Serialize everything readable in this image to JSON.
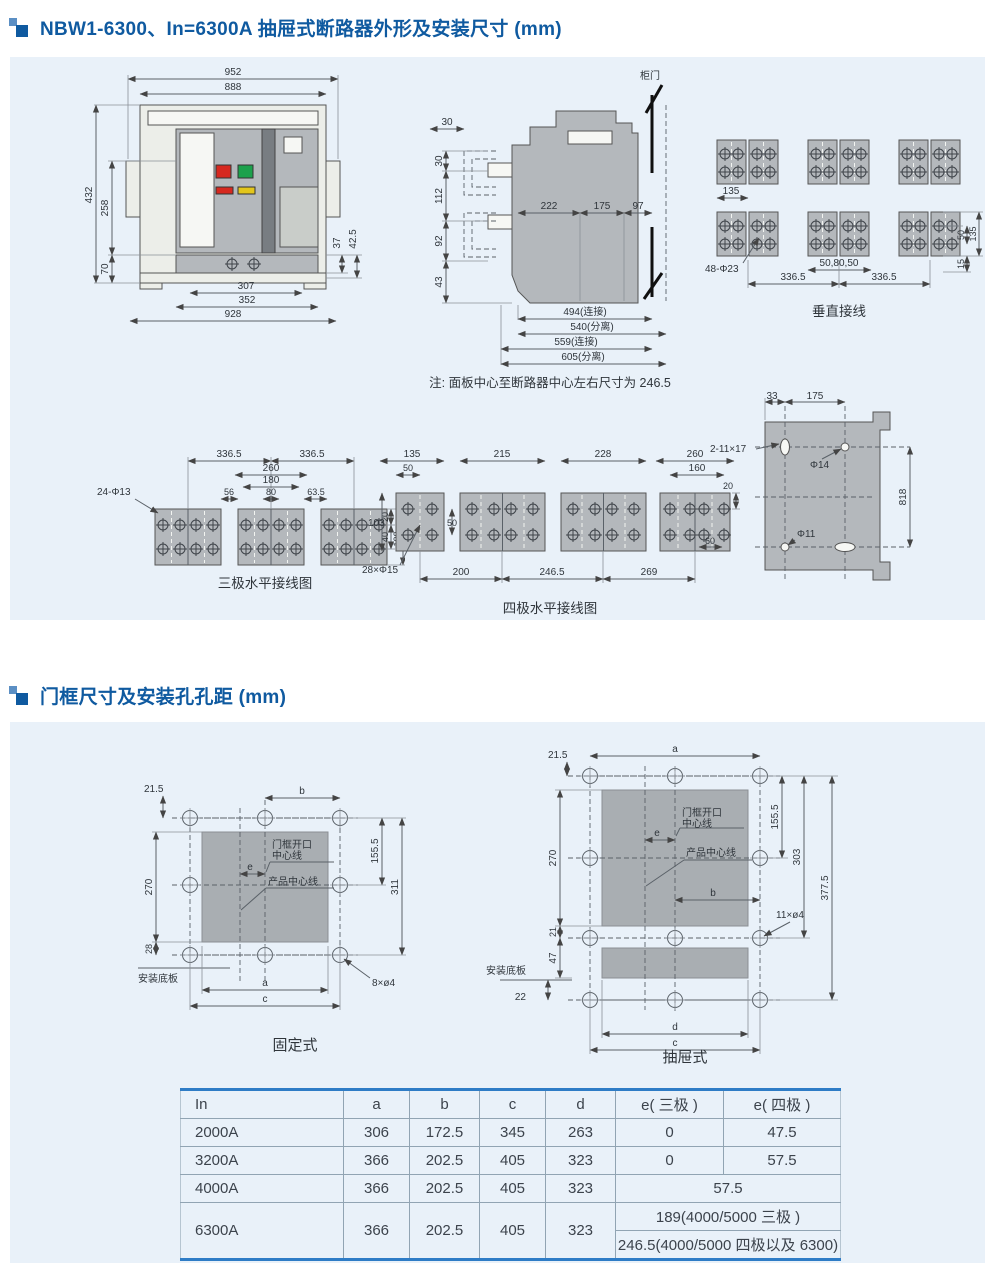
{
  "sections": {
    "s1": "NBW1-6300、In=6300A 抽屉式断路器外形及安装尺寸 (mm)",
    "s2": "门框尺寸及安装孔孔距 (mm)"
  },
  "front": {
    "w952": "952",
    "w888": "888",
    "h432": "432",
    "h258": "258",
    "h70": "70",
    "h37": "37",
    "h425": "42.5",
    "w307": "307",
    "w352": "352",
    "w928": "928"
  },
  "side": {
    "door": "柜门",
    "t30": "30",
    "l30": "30",
    "l112": "112",
    "l92": "92",
    "l43": "43",
    "m222": "222",
    "m175": "175",
    "m97": "97",
    "b494": "494(连接)",
    "b540": "540(分离)",
    "b559": "559(连接)",
    "b605": "605(分离)",
    "note": "注: 面板中心至断路器中心左右尺寸为 246.5"
  },
  "vert": {
    "caption": "垂直接线",
    "d135": "135",
    "d48": "48-Φ23",
    "d505080": "50,80,50",
    "d3365a": "336.5",
    "d3365b": "336.5",
    "r50": "50",
    "r135": "135",
    "r15": "15"
  },
  "three": {
    "caption": "三极水平接线图",
    "d24": "24-Φ13",
    "d3365a": "336.5",
    "d3365b": "336.5",
    "d260": "260",
    "d180": "180",
    "d56": "56",
    "d80": "80",
    "d635": "63.5",
    "r20": "20",
    "r40": "40",
    "r100": "100"
  },
  "four": {
    "caption": "四极水平接线图",
    "d135": "135",
    "d50t": "50",
    "d215": "215",
    "d228": "228",
    "d260": "260",
    "d160": "160",
    "l103": "103",
    "m50": "50",
    "d28": "28×Φ15",
    "b200": "200",
    "b2465": "246.5",
    "b269": "269",
    "d60": "60",
    "r20": "20"
  },
  "plate": {
    "d33": "33",
    "d175": "175",
    "d2x11": "2-11×17",
    "dphi14": "Φ14",
    "dphi11": "Φ11",
    "d818": "818"
  },
  "fixed": {
    "caption": "固定式",
    "d215": "21.5",
    "db": "b",
    "d270": "270",
    "d28": "28",
    "d1555": "155.5",
    "d311": "311",
    "de": "e",
    "da": "a",
    "dc": "c",
    "d8o4": "8×ø4",
    "base": "安装底板",
    "door1": "门框开口",
    "door2": "中心线",
    "product": "产品中心线"
  },
  "drawout": {
    "caption": "抽屉式",
    "d215": "21.5",
    "da": "a",
    "d270": "270",
    "d21": "21",
    "d47": "47",
    "d22": "22",
    "d1555": "155.5",
    "d303": "303",
    "d3775": "377.5",
    "de": "e",
    "db": "b",
    "dd": "d",
    "dc": "c",
    "d11o4": "11×ø4",
    "base": "安装底板",
    "door1": "门框开口",
    "door2": "中心线",
    "product": "产品中心线"
  },
  "table": {
    "headers": [
      "In",
      "a",
      "b",
      "c",
      "d",
      "e( 三极 )",
      "e( 四极 )"
    ],
    "r1": [
      "2000A",
      "306",
      "172.5",
      "345",
      "263",
      "0",
      "47.5"
    ],
    "r2": [
      "3200A",
      "366",
      "202.5",
      "405",
      "323",
      "0",
      "57.5"
    ],
    "r3": [
      "4000A",
      "366",
      "202.5",
      "405",
      "323",
      "57.5"
    ],
    "r4": [
      "6300A",
      "366",
      "202.5",
      "405",
      "323",
      "189(4000/5000 三极 )",
      "246.5(4000/5000 四极以及 6300)"
    ]
  }
}
